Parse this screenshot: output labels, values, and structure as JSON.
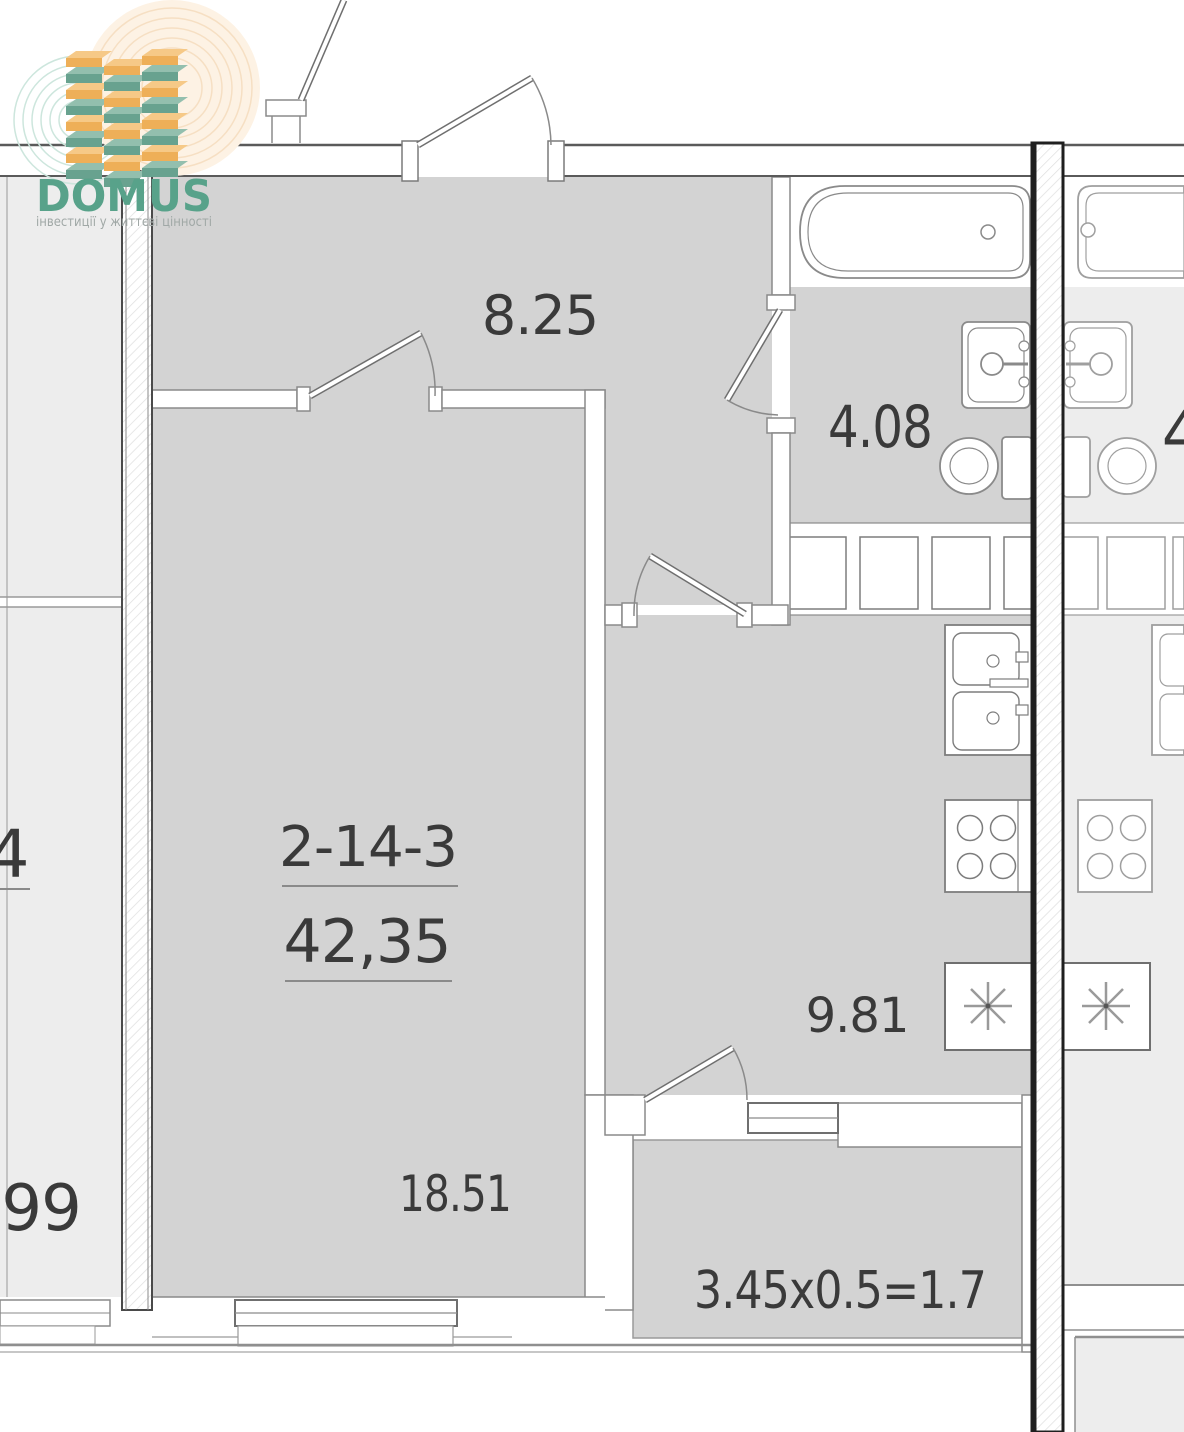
{
  "logo": {
    "brand": "DOMUS",
    "tagline": "інвестиції у життєві цінності"
  },
  "unit": {
    "id": "2-14-3",
    "total_area": "42,35"
  },
  "rooms": {
    "hallway": {
      "area": "8.25"
    },
    "bathroom": {
      "area": "4.08"
    },
    "kitchen": {
      "area": "9.81"
    },
    "living_room": {
      "area": "18.51"
    },
    "balcony": {
      "area_formula": "3.45x0.5=1.7"
    }
  },
  "neighbor_labels": {
    "left_unit_fragment": "4",
    "left_area_fragment": ".99",
    "right_area_fragment": "4"
  },
  "colors": {
    "apartment_floor": "#d3d3d3",
    "neighbor_floor": "#ededed",
    "wall_line": "#8a8a8a",
    "party_wall": "#1f1f1f",
    "label_text": "#3a3a3a",
    "logo_green": "#58a28a",
    "logo_tagline": "#a0a8a6",
    "logo_orange_front": "#eeaf58",
    "logo_orange_top": "#f6c987",
    "logo_teal_front": "#68a28f",
    "logo_teal_top": "#93bfae",
    "logo_ring_teal": "#cde6dd",
    "logo_ring_peach": "#f6dfc3"
  }
}
